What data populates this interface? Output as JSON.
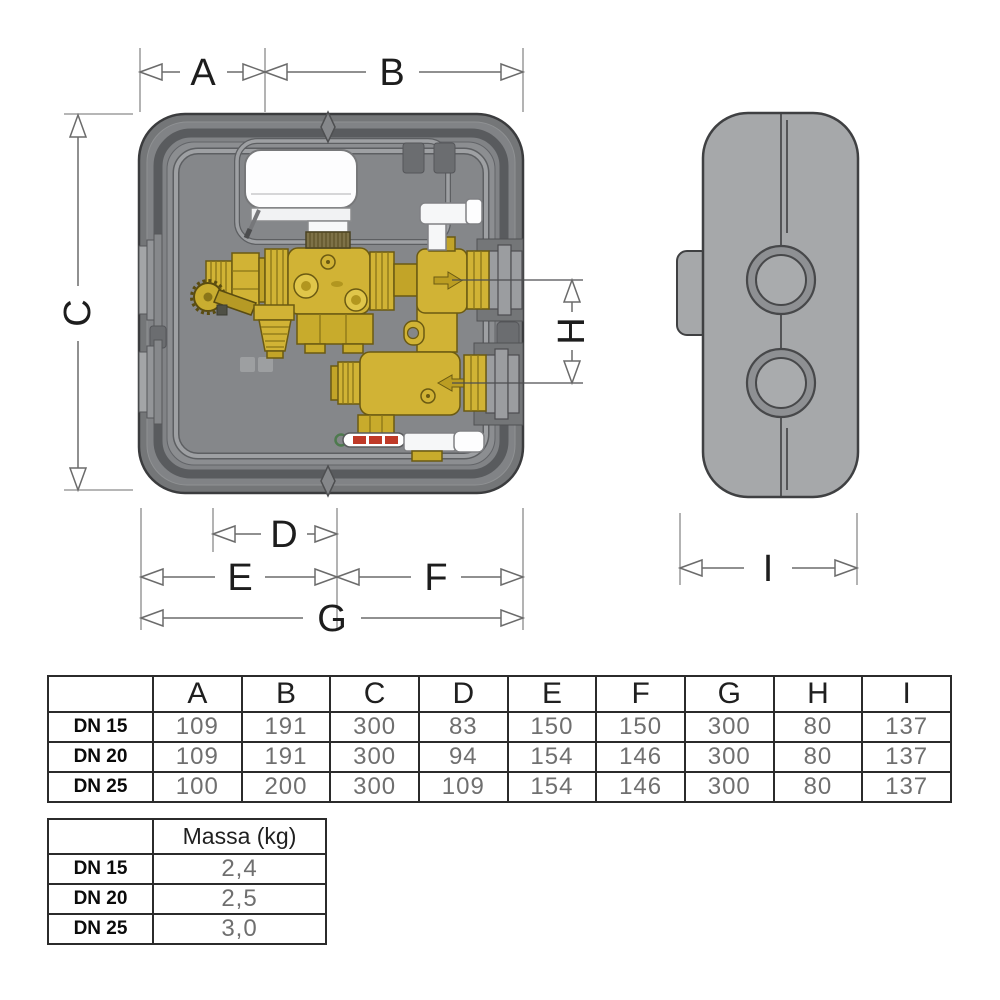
{
  "diagram": {
    "labels": {
      "a": "A",
      "b": "B",
      "c": "C",
      "d": "D",
      "e": "E",
      "f": "F",
      "g": "G",
      "h": "H",
      "i": "I"
    }
  },
  "dimensions_table": {
    "col_headers": [
      "A",
      "B",
      "C",
      "D",
      "E",
      "F",
      "G",
      "H",
      "I"
    ],
    "rows": [
      {
        "label": "DN 15",
        "values": [
          "109",
          "191",
          "300",
          "83",
          "150",
          "150",
          "300",
          "80",
          "137"
        ]
      },
      {
        "label": "DN 20",
        "values": [
          "109",
          "191",
          "300",
          "94",
          "154",
          "146",
          "300",
          "80",
          "137"
        ]
      },
      {
        "label": "DN 25",
        "values": [
          "100",
          "200",
          "300",
          "109",
          "154",
          "146",
          "300",
          "80",
          "137"
        ]
      }
    ]
  },
  "mass_table": {
    "header": "Massa (kg)",
    "rows": [
      {
        "label": "DN 15",
        "value": "2,4"
      },
      {
        "label": "DN 20",
        "value": "2,5"
      },
      {
        "label": "DN 25",
        "value": "3,0"
      }
    ]
  },
  "colors": {
    "brass": "#d1b335",
    "case_gray": "#85878a",
    "rim_gray": "#747678",
    "side_body_gray": "#a6a8aa",
    "dimension_line": "#6b6b6b",
    "label_text": "#1d1d1d",
    "table_number_text": "#6f6f6f",
    "thermometer_red": "#bf3a28"
  }
}
